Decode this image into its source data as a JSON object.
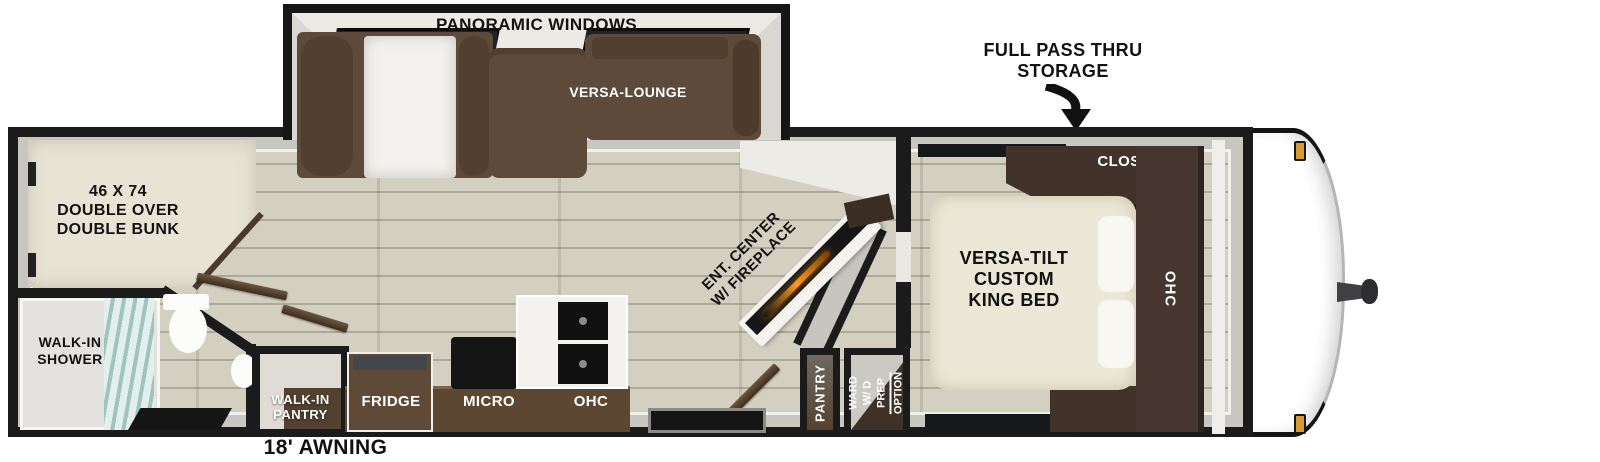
{
  "labels": {
    "panoramic_windows": "PANORAMIC WINDOWS",
    "versa_lounge": "VERSA-LOUNGE",
    "pass_thru_storage": "FULL PASS THRU\nSTORAGE",
    "closet": "CLOSET",
    "bedroom_ohc": "OHC",
    "king_bed": "VERSA-TILT\nCUSTOM\nKING BED",
    "bunk": "46 X 74\nDOUBLE OVER\nDOUBLE BUNK",
    "walk_in_shower": "WALK-IN\nSHOWER",
    "walk_in_pantry": "WALK-IN\nPANTRY",
    "fridge": "FRIDGE",
    "micro": "MICRO",
    "kitchen_ohc": "OHC",
    "ent_center": "ENT. CENTER\nW/ FIREPLACE",
    "pantry": "PANTRY",
    "ward": "WARD\nW/ D PREP",
    "ward_option": "OPTION",
    "awning": "18' AWNING"
  },
  "colors": {
    "outline": "#1b1b1b",
    "floor": "#d3d0c1",
    "wall_gray": "#c8c6c0",
    "sofa_brown": "#5d4a3a",
    "cabinet_brown": "#41332a",
    "mattress_cream": "#ece8d7",
    "fire_orange": "#ff9a1e",
    "amber_light": "#d99a33"
  }
}
